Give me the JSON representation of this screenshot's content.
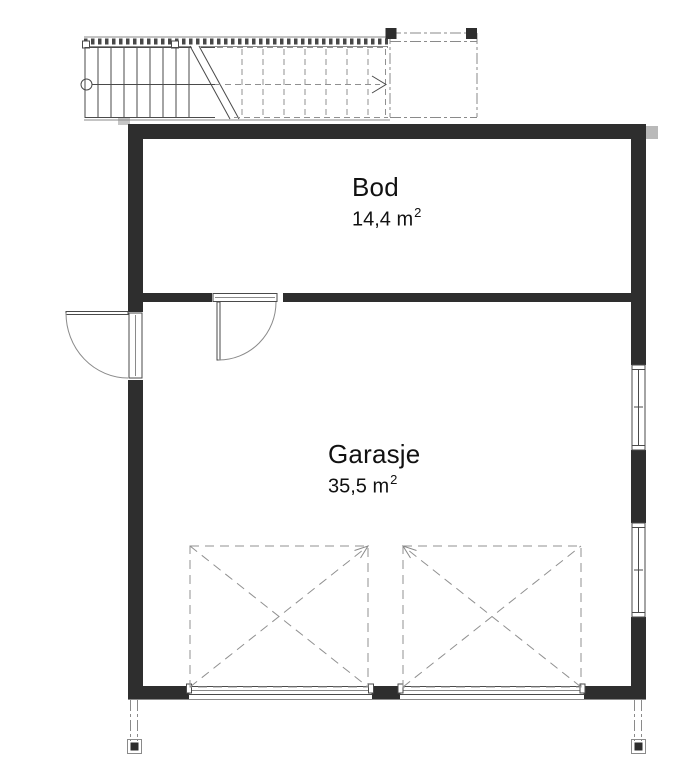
{
  "drawing": {
    "type": "floor-plan",
    "rooms": [
      {
        "name": "Bod",
        "area_text": "14,4 m",
        "area_sup": "2"
      },
      {
        "name": "Garasje",
        "area_text": "35,5 m",
        "area_sup": "2"
      }
    ],
    "features": [
      "external-stair",
      "landing-platform",
      "exterior-door",
      "interior-door",
      "window",
      "window",
      "garage-door-opening",
      "garage-door-opening",
      "column-footing",
      "column-footing"
    ]
  },
  "colors": {
    "wall": "#2e2e2e",
    "line": "#4a4a4a",
    "light_line": "#8a8a8a",
    "dash_line": "#909090",
    "text": "#111111",
    "bg": "#ffffff"
  }
}
